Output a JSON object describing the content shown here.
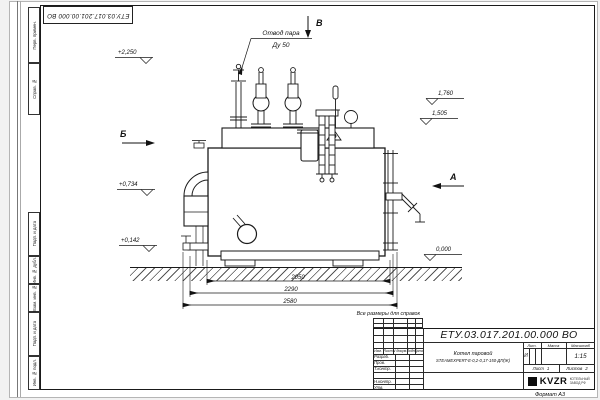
{
  "doc_number": "ЕТУ.03.017.201.00.000  ВО",
  "stamp_top": "ЕТУ.03.017.201.00.000  ВО",
  "note_reference": "Все размеры для справок",
  "format_label": "Формат А3",
  "callout": {
    "line1": "Отвод пара",
    "line2": "Ду 50"
  },
  "view_markers": {
    "b": "Б",
    "a": "А",
    "v": "В"
  },
  "elevations": {
    "e2250": "+2,250",
    "e1760": "1,760",
    "e1505": "1,505",
    "e0734": "+0,734",
    "e0142": "+0,142",
    "e0000": "0,000"
  },
  "dimensions": {
    "d2050": "2050",
    "d2290": "2290",
    "d2580": "2580"
  },
  "title_block": {
    "name_line1": "Котел паровой",
    "name_line2": "STEAMEXPERT-Е-0,2-0,17-150-ДП(Ж)",
    "col_izm": "Изм.",
    "col_list": "Лист",
    "col_doc": "N докум.",
    "col_podp": "Подп.",
    "col_data": "Дата",
    "row_razrab": "Разраб.",
    "row_prov": "Пров.",
    "row_tkontr": "Т.контр.",
    "row_nkontr": "Н.контр.",
    "row_utv": "Утв.",
    "lit_header": "Лит.",
    "massa_header": "Масса",
    "masshtab_header": "Масштаб",
    "lit_value": "И",
    "scale_value": "1:15",
    "sheet_label": "Лист",
    "sheet_value": "1",
    "sheets_label": "Листов",
    "sheets_value": "2",
    "company": "KVZR",
    "company_sub1": "КОТЕЛЬНЫЙ",
    "company_sub2": "ЗАВОД РФ"
  },
  "margin_labels": [
    "Перв. примен.",
    "Справ. №",
    "Подп. и дата",
    "Инв. № дубл.",
    "Взам. инв. №",
    "Подп. и дата",
    "Инв. № подл."
  ]
}
